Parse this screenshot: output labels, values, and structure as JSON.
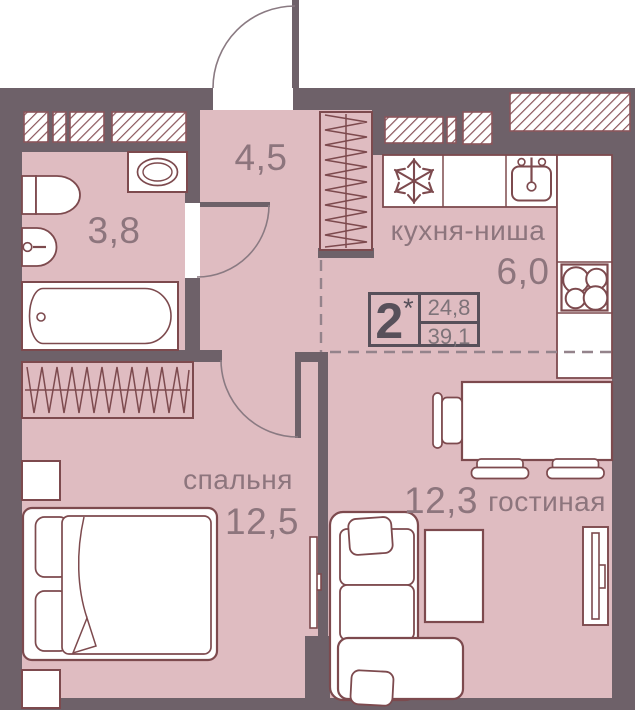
{
  "badge": {
    "number": "2",
    "star": "*",
    "living_area": "24,8",
    "total_area": "39,1"
  },
  "rooms": {
    "hallway": {
      "area": "4,5"
    },
    "bathroom": {
      "area": "3,8"
    },
    "kitchen": {
      "name": "кухня-ниша",
      "area": "6,0"
    },
    "bedroom": {
      "name": "спальня",
      "area": "12,5"
    },
    "living": {
      "name": "гостиная",
      "area": "12,3"
    }
  },
  "colors": {
    "wall": "#6e6169",
    "floor": "#dfbcc1",
    "fixture_outline": "#7d4a4e",
    "hatch": "#8a555b",
    "label_text": "#8d757d",
    "badge_border": "#57505a",
    "dash": "#94838b"
  },
  "icons": {
    "fridge": "snowflake-icon",
    "stove": "four-burners-icon",
    "kitchen_sink": "sink-with-tap-icon",
    "bath_sink": "washbasin-icon",
    "toilet": "toilet-icon",
    "washer": "washing-machine-icon",
    "wardrobe": "hanger-zigzag-icon",
    "tv": "wall-tv-icon",
    "doors": "door-swing-arc-icon",
    "vent_shaft": "diagonal-hatch-icon"
  }
}
